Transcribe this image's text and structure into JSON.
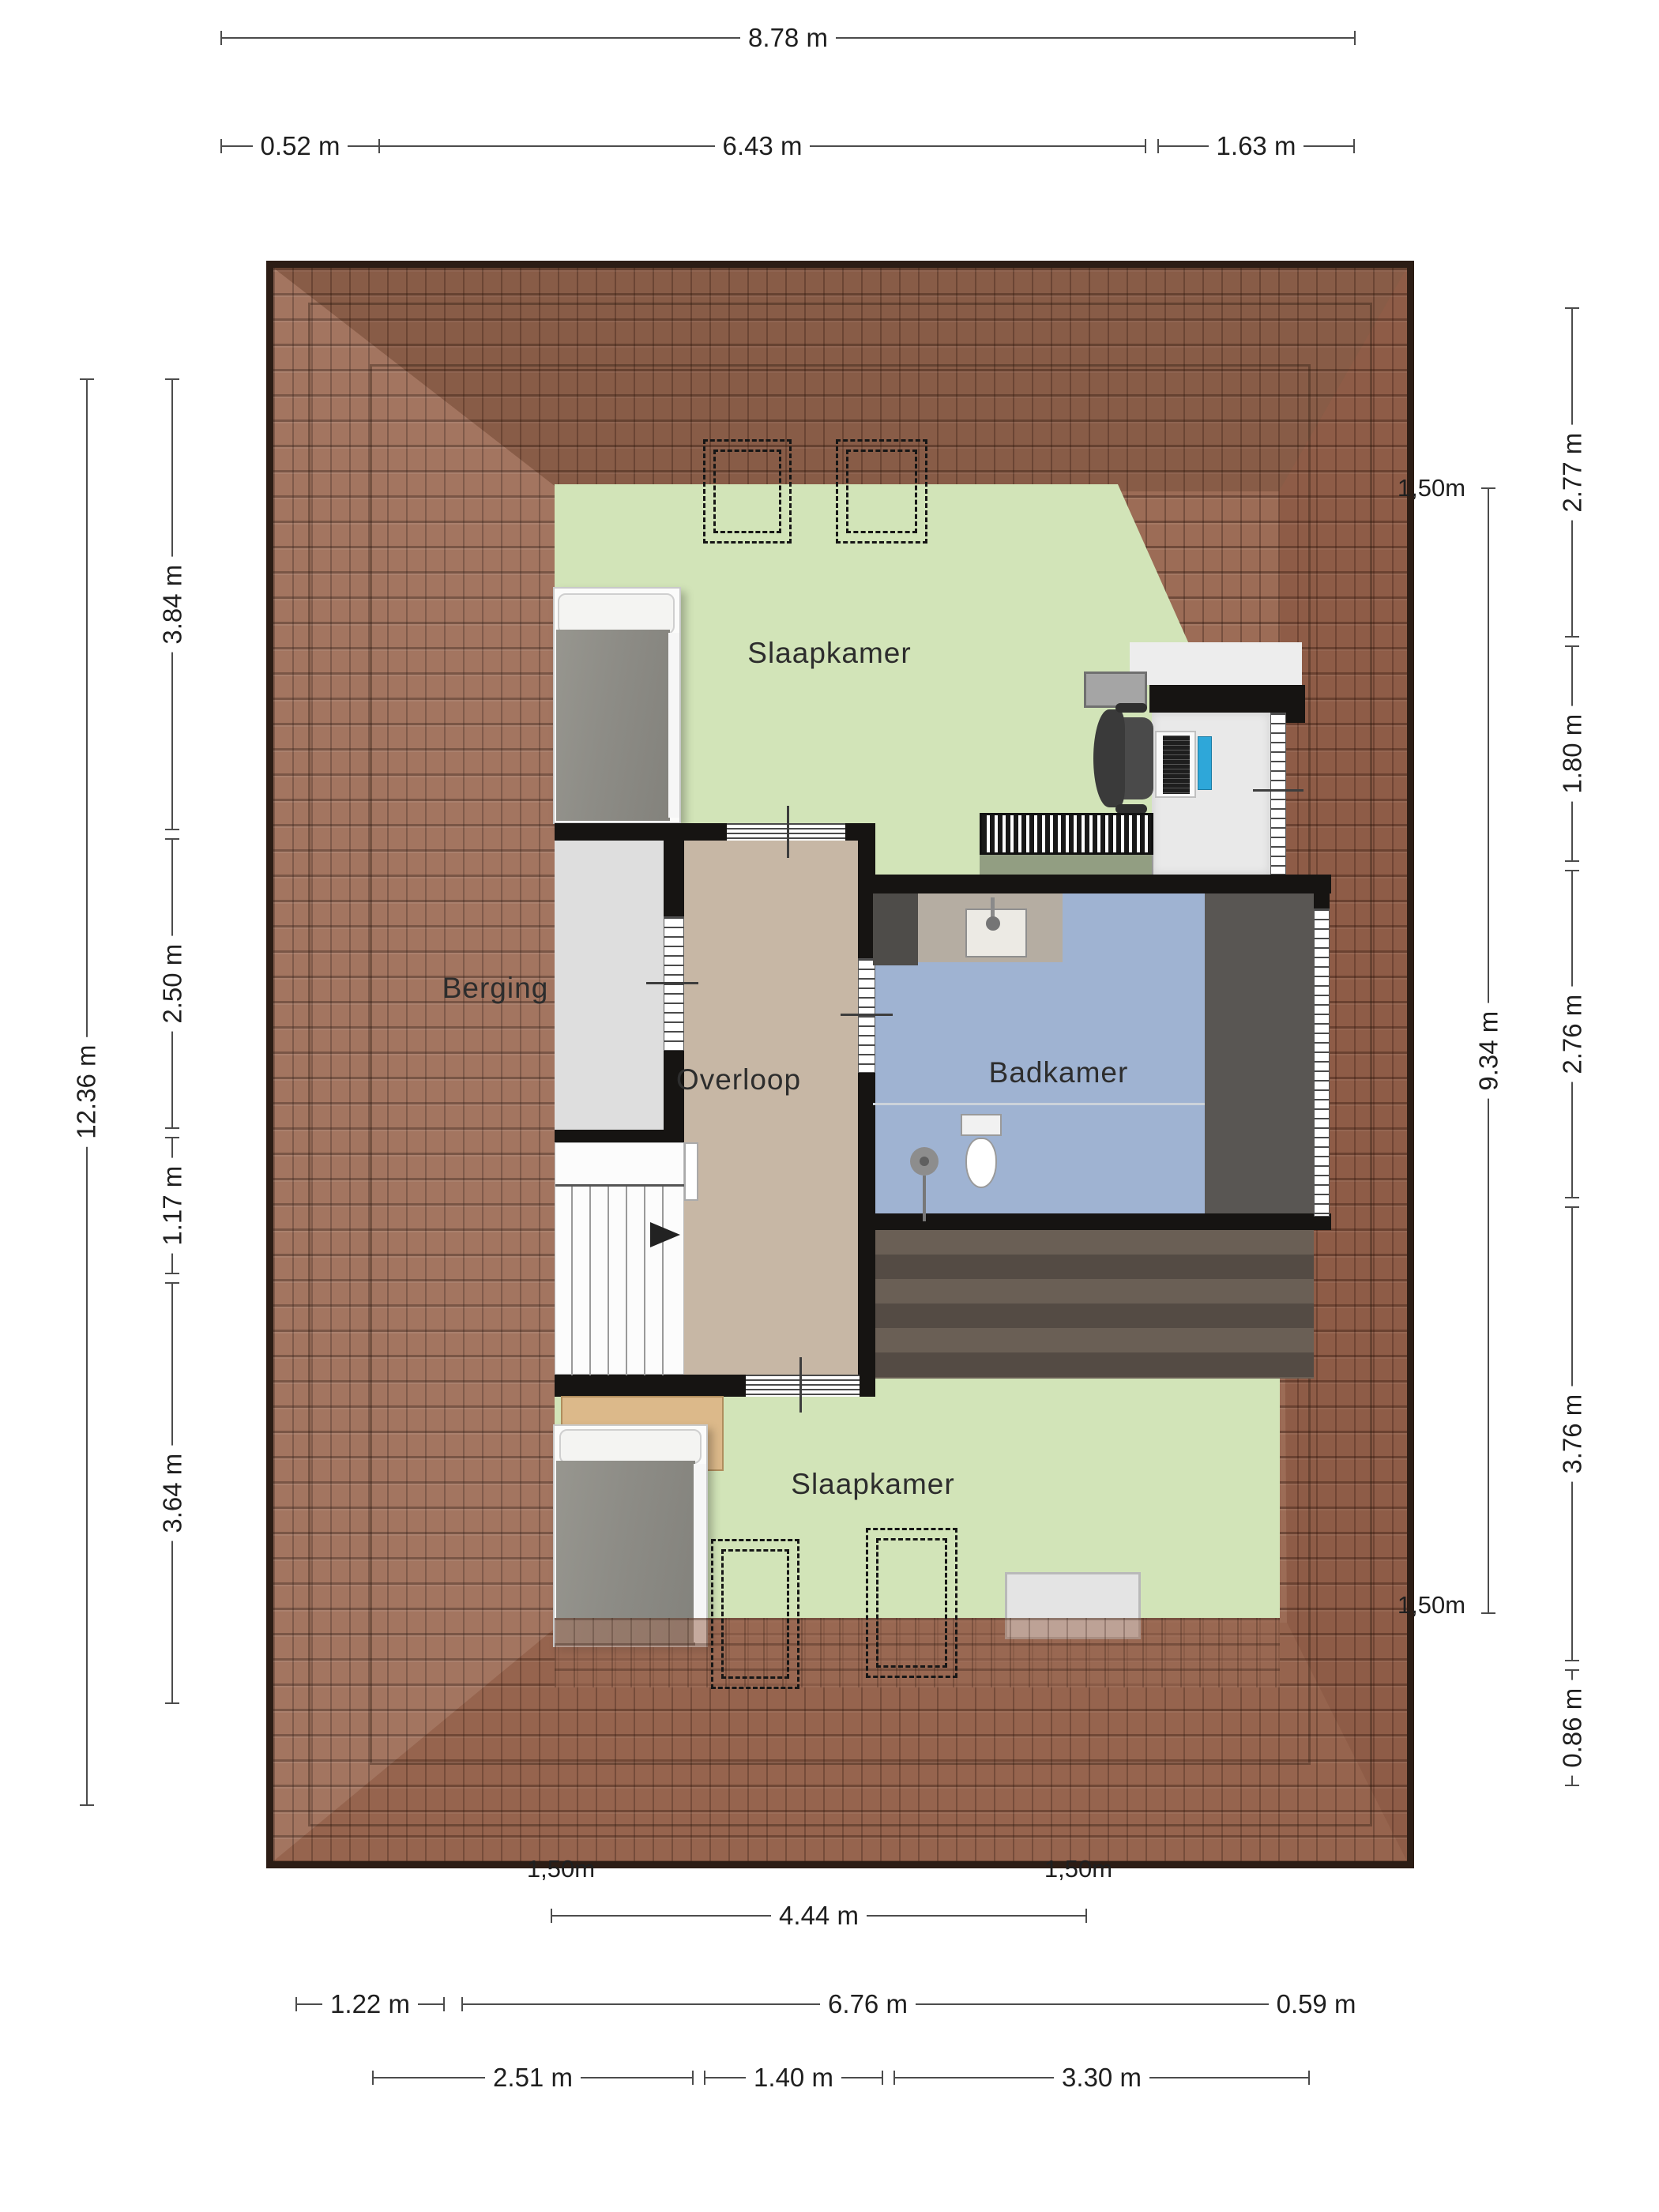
{
  "rooms": {
    "bedroom_top": "Slaapkamer",
    "storage": "Berging",
    "landing": "Overloop",
    "bathroom": "Badkamer",
    "bedroom_bottom": "Slaapkamer"
  },
  "dimensions": {
    "top": {
      "overall": "8.78 m",
      "seg1": "0.52 m",
      "seg2": "6.43 m",
      "seg3": "1.63 m"
    },
    "left": {
      "overall": "12.36 m",
      "seg1": "3.84 m",
      "seg2": "2.50 m",
      "seg3": "1.17 m",
      "seg4": "3.64 m"
    },
    "right": {
      "overall": "9.34 m",
      "seg1": "2.77 m",
      "seg2": "1.80 m",
      "seg3": "2.76 m",
      "seg4": "3.76 m",
      "seg5": "0.86 m"
    },
    "bottom": {
      "mid": "4.44 m",
      "seg1": "1.22 m",
      "seg2": "6.76 m",
      "seg3": "0.59 m",
      "seg4": "2.51 m",
      "seg5": "1.40 m",
      "seg6": "3.30 m"
    }
  },
  "height_markers": {
    "top_right": "1,50m",
    "bottom_right_outer": "1,50m",
    "bottom_left_inner": "1,50m",
    "bottom_right_inner": "1,50m"
  },
  "colors": {
    "roof": "#9c6c56",
    "roof_border": "#2c1d15",
    "bedroom_floor": "#d2e4b8",
    "landing_floor": "#c7b7a5",
    "storage_floor": "#dedede",
    "bathroom_floor": "#9fb3d2",
    "dark_tile_floor": "#59565",
    "wood_floor": "#5d544c",
    "wall": "#161412",
    "dimension_line": "#4c4c4c"
  }
}
